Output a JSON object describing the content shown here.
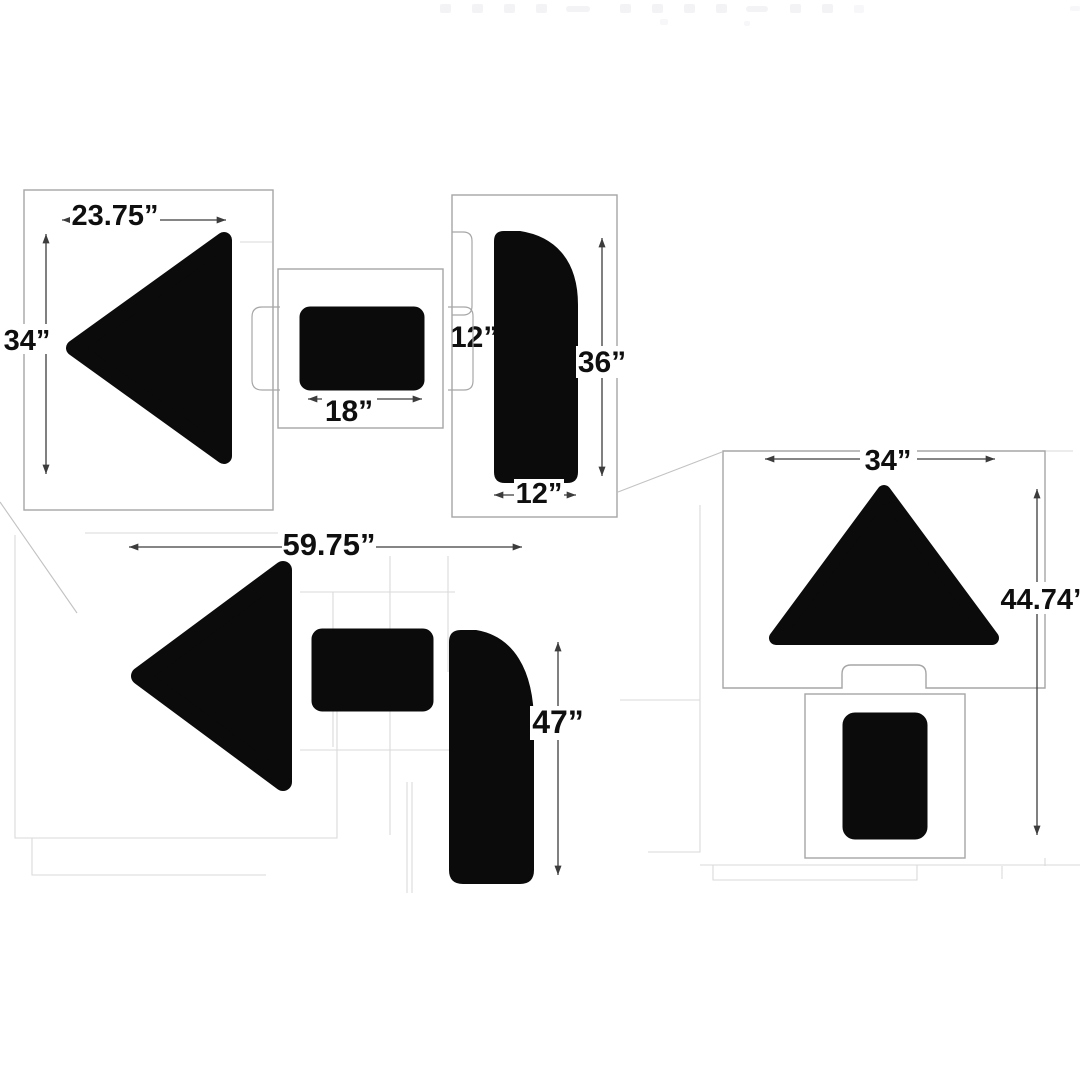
{
  "page": {
    "background": "#ffffff",
    "description": "Dimension diagram of a pavement turn-arrow stencil kit: arrowhead, rectangle and curved-stem stencil sheets shown separately and assembled, with inch dimension callouts"
  },
  "colors": {
    "bg": "#ffffff",
    "shape": "#0b0b0b",
    "sheet": "#a6a6a6",
    "faint": "#dadada",
    "dim": "#3c3c3c",
    "label": "#0f0f0f"
  },
  "labels": {
    "arrowhead_width": "23.75”",
    "arrowhead_height": "34”",
    "rect_height": "12”",
    "rect_width": "18”",
    "stem_height": "36”",
    "stem_width": "12”",
    "assembled_width": "59.75”",
    "turn_stem_height": "47”",
    "up_triangle_width": "34”",
    "up_assembled_height": "44.74”"
  }
}
